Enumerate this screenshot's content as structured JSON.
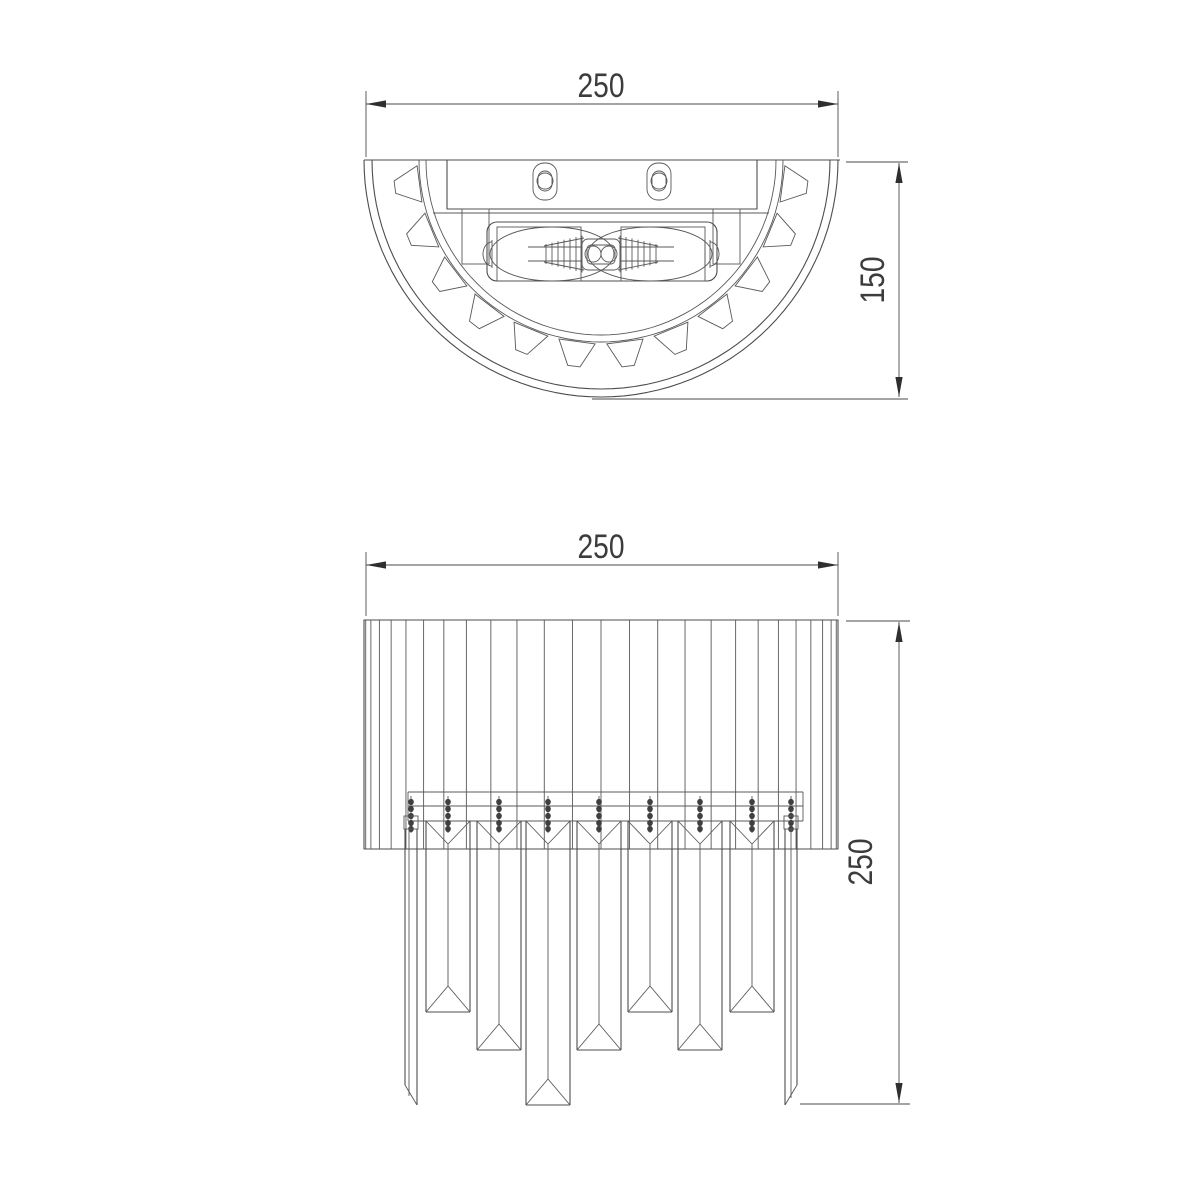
{
  "page": {
    "background": "#ffffff"
  },
  "drawing": {
    "type": "technical-dimension-drawing",
    "subject": "crystal-wall-sconce",
    "stroke_color": "#4d4d4d",
    "dim_color": "#3c3c3c",
    "views": {
      "top_view": {
        "name": "top view (plan, semicircular body)",
        "width_dim": {
          "value": "250"
        },
        "depth_dim": {
          "value": "150"
        }
      },
      "front_view": {
        "name": "front view (fluted shade with crystal prisms)",
        "width_dim": {
          "value": "250"
        },
        "height_dim": {
          "value": "250"
        }
      }
    }
  }
}
